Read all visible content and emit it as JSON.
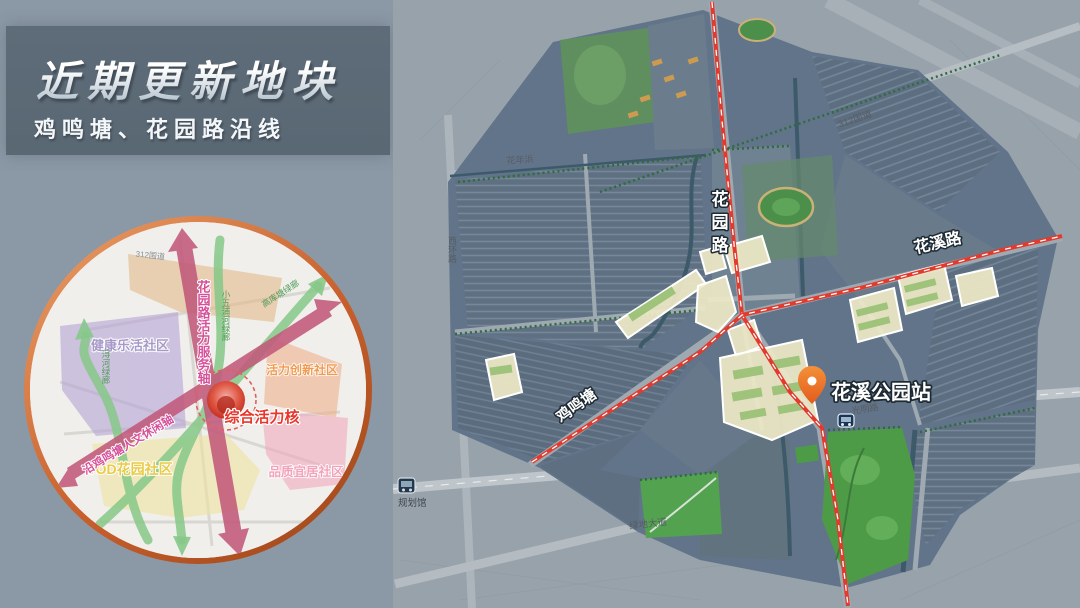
{
  "slide": {
    "title": "近期更新地块",
    "subtitle": "鸡鸣塘、花园路沿线"
  },
  "colors": {
    "background": "#8B98A6",
    "title_panel": "#5D6B78",
    "route_red": "#E23B2E",
    "pin_orange": "#F07A28",
    "inset_border": "#C4673A",
    "park_green": "#4D9B47"
  },
  "inset": {
    "core_label": "综合活力核",
    "zones": [
      {
        "label": "健康乐活社区",
        "color": "#A79AC8"
      },
      {
        "label": "活力创新社区",
        "color": "#F09A50"
      },
      {
        "label": "TOD花园社区",
        "color": "#E9CB45"
      },
      {
        "label": "品质宜居社区",
        "color": "#F3A2BA"
      }
    ],
    "axes": [
      {
        "label": "花园路活力服务轴"
      },
      {
        "label": "沿鸡鸣塘人文休闲轴"
      }
    ],
    "corridors": [
      {
        "label": "浔河绿廊"
      },
      {
        "label": "小五浦河绿廊"
      },
      {
        "label": "高库塘绿廊"
      }
    ],
    "road_label": "312国道"
  },
  "map": {
    "station_label": "花溪公园站",
    "poi_label": "规划馆",
    "labels": {
      "g312": "312国道",
      "huanianbang": "花年浜",
      "xihuan": "西环路",
      "huayuan": "花园路",
      "huaxi_road": "花溪路",
      "jiming": "鸡鸣塘",
      "guangming": "光明路",
      "lvdi": "绿地大道"
    }
  }
}
